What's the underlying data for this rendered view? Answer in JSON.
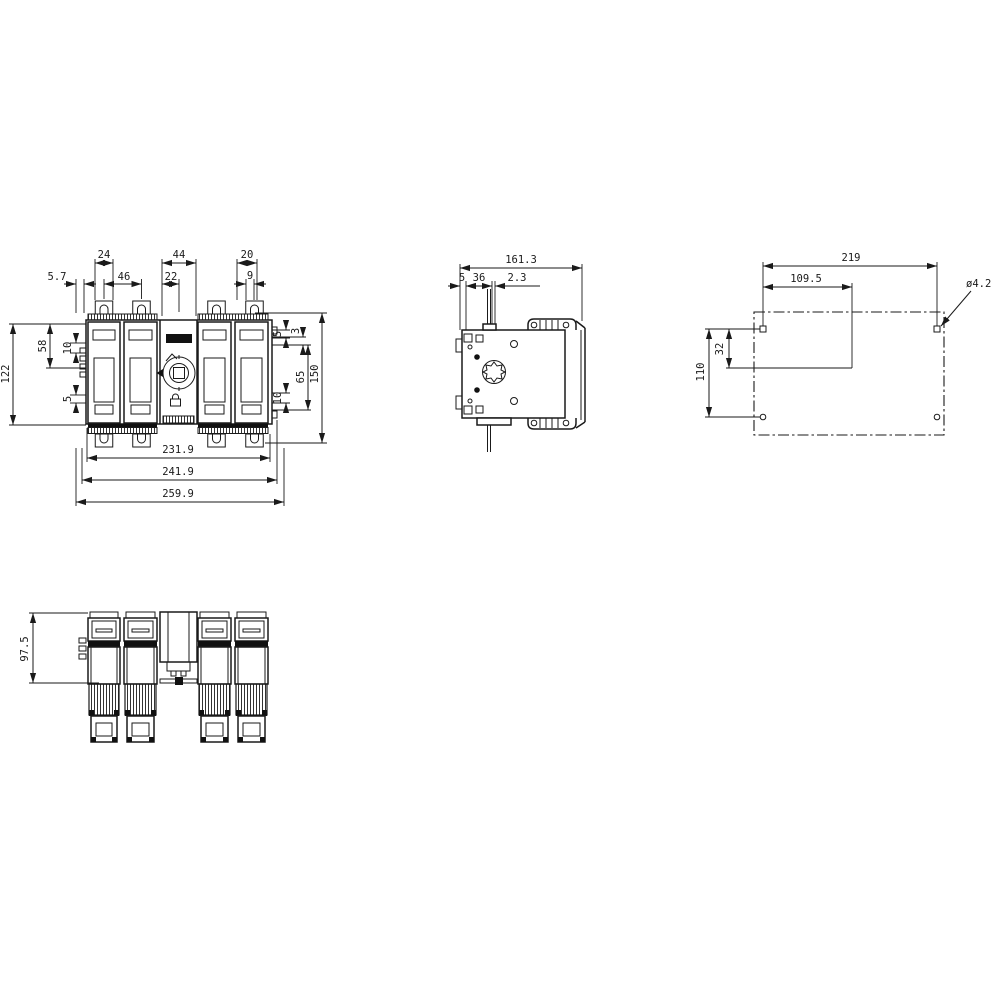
{
  "meta": {
    "drawing_type": "technical dimension drawing",
    "subject": "4-pole switch disconnector with fuses, four views"
  },
  "colors": {
    "background": "#ffffff",
    "line": "#1a1a1a",
    "solid_fill": "#111111"
  },
  "front_view": {
    "top_dims": {
      "pole_width": "24",
      "center_width": "44",
      "tab_width": "20",
      "edge_offset": "5.7",
      "pole_pitch": "46",
      "center_offset": "22",
      "tab_offset": "9"
    },
    "left_dims": {
      "body_height": "122",
      "top_to_center": "58",
      "upper_small": "10",
      "lower_small": "5"
    },
    "right_dims": {
      "step": "3",
      "center_to_bottom": "65",
      "overall_height": "150",
      "upper_small": "5",
      "lower_small": "10"
    },
    "bottom_dims": {
      "inner_width": "231.9",
      "mid_width": "241.9",
      "overall_width": "259.9"
    }
  },
  "side_view": {
    "dims": {
      "overall_depth": "161.3",
      "front_offset": "5",
      "terminal_depth": "36",
      "plate_thickness": "2.3"
    }
  },
  "drilling_plan": {
    "dims": {
      "horizontal_pitch": "219",
      "horizontal_half": "109.5",
      "vertical_pitch": "110",
      "vertical_offset": "32",
      "hole_diameter": "ø4.2"
    }
  },
  "bottom_view": {
    "dims": {
      "body_depth": "97.5"
    }
  }
}
